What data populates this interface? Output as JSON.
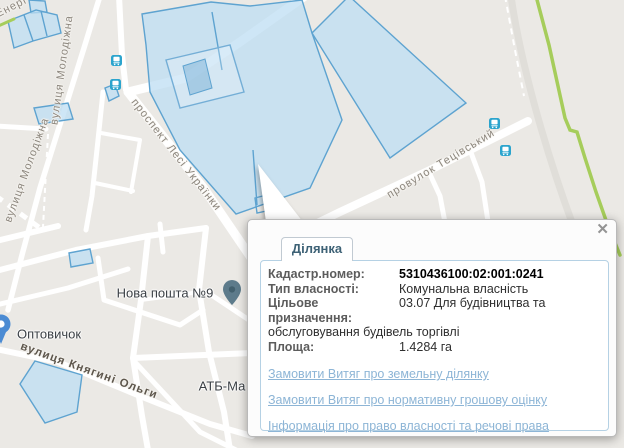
{
  "popup": {
    "tab_label": "Ділянка",
    "close_glyph": "✕",
    "fields": [
      {
        "label": "Кадастр.номер:",
        "value": "5310436100:02:001:0241"
      },
      {
        "label": "Тип власності:",
        "value": "Комунальна власність"
      },
      {
        "label": "Цільове призначення:",
        "value": "03.07 Для будівництва та обслуговування будівель торгівлі"
      },
      {
        "label": "Площа:",
        "value": "1.4284 га"
      }
    ],
    "links": [
      "Замовити Витяг про земельну ділянку",
      "Замовити Витяг про нормативну грошову оцінку",
      "Інформація про право власності та речові права"
    ]
  },
  "map": {
    "street_labels": [
      {
        "text": "Енерг"
      },
      {
        "text": "вулиця Молодіжна"
      },
      {
        "text": "вулиця Молодіжна"
      },
      {
        "text": "проспект Лесі Українки"
      },
      {
        "text": "провулок Тецівський"
      },
      {
        "text": "вулиця Княгині Ольги"
      }
    ],
    "poi_labels": [
      {
        "text": "Нова пошта №9"
      },
      {
        "text": "Оптовичок"
      },
      {
        "text": "АТБ-Ма"
      }
    ],
    "icons": [
      "bus-stop-icon",
      "place-pin-icon",
      "shop-pin-icon",
      "close-icon"
    ],
    "colors": {
      "map_background": "#ebe9e5",
      "road": "#ffffff",
      "parcel_fill": "#bddef3",
      "parcel_stroke": "#5ea3d0",
      "green_route": "#a6cd5b",
      "bus_icon": "#2ba4cd",
      "link_accent": "#8db5d6",
      "tab_text": "#3e6276"
    }
  }
}
